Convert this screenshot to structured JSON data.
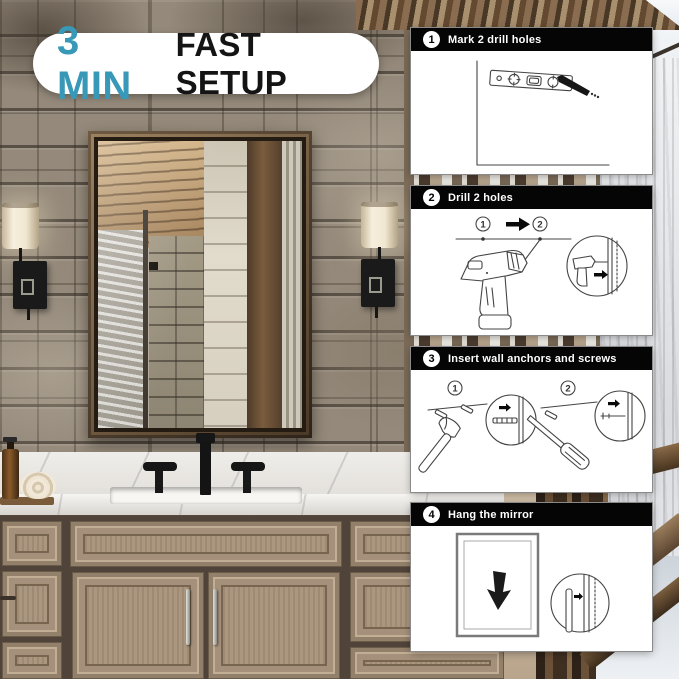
{
  "badge": {
    "time": "3 MIN",
    "label": "FAST SETUP"
  },
  "colors": {
    "accent": "#3898b8",
    "panel_header": "#000000",
    "panel_bg": "#ffffff"
  },
  "steps": [
    {
      "number": "1",
      "title": "Mark 2 drill holes"
    },
    {
      "number": "2",
      "title": "Drill 2 holes",
      "marker_1": "1",
      "marker_2": "2"
    },
    {
      "number": "3",
      "title": "Insert wall anchors and screws",
      "marker_1": "1",
      "marker_2": "2"
    },
    {
      "number": "4",
      "title": "Hang the mirror"
    }
  ]
}
